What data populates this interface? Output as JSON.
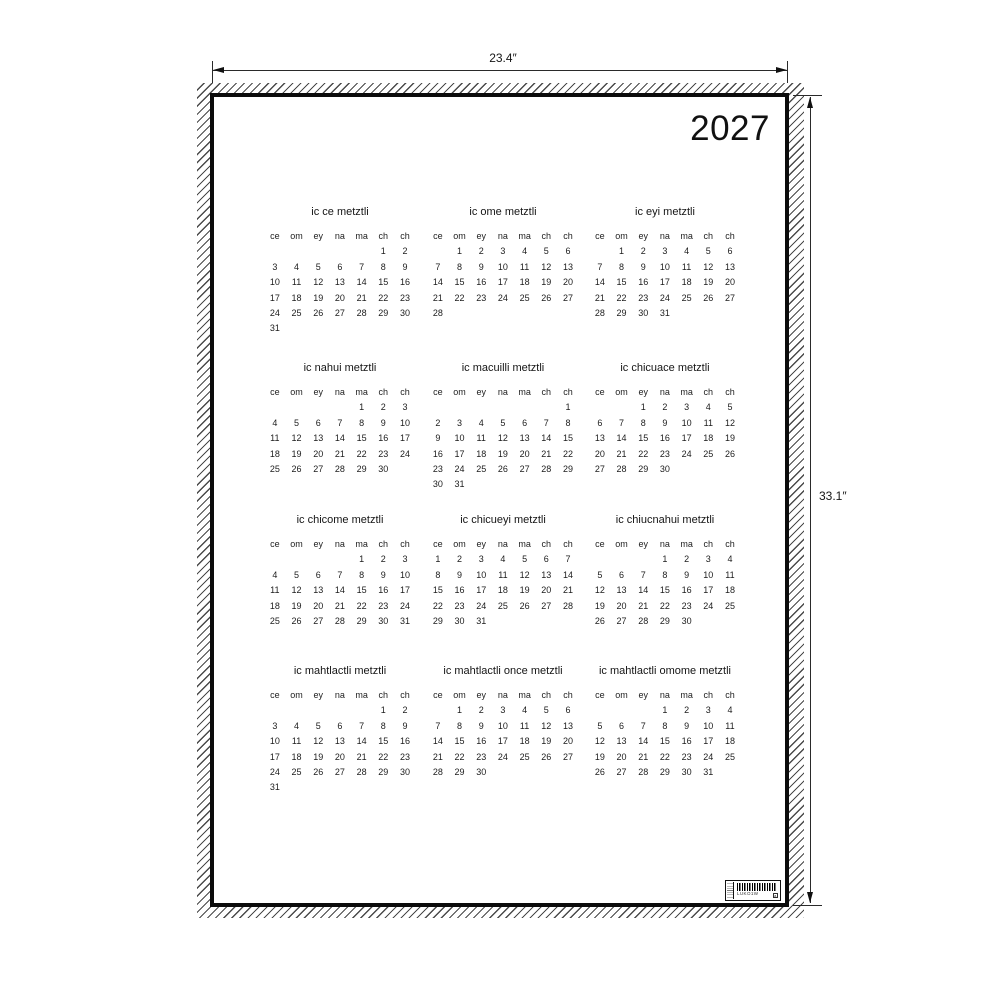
{
  "product": {
    "year": "2027",
    "width_label": "23.4″",
    "height_label": "33.1″"
  },
  "colors": {
    "paper": "#ffffff",
    "ink": "#1a1a1a",
    "border": "#0b0b0b",
    "hatch": "#4a4a4a"
  },
  "calendar": {
    "day_headers": [
      "ce",
      "om",
      "ey",
      "na",
      "ma",
      "ch",
      "ch"
    ],
    "months": [
      {
        "name": "ic ce metztli",
        "weeks": [
          [
            "",
            "",
            "",
            "",
            "",
            "1",
            "2"
          ],
          [
            "3",
            "4",
            "5",
            "6",
            "7",
            "8",
            "9"
          ],
          [
            "10",
            "11",
            "12",
            "13",
            "14",
            "15",
            "16"
          ],
          [
            "17",
            "18",
            "19",
            "20",
            "21",
            "22",
            "23"
          ],
          [
            "24",
            "25",
            "26",
            "27",
            "28",
            "29",
            "30"
          ],
          [
            "31",
            "",
            "",
            "",
            "",
            "",
            ""
          ]
        ]
      },
      {
        "name": "ic ome metztli",
        "weeks": [
          [
            "",
            "1",
            "2",
            "3",
            "4",
            "5",
            "6"
          ],
          [
            "7",
            "8",
            "9",
            "10",
            "11",
            "12",
            "13"
          ],
          [
            "14",
            "15",
            "16",
            "17",
            "18",
            "19",
            "20"
          ],
          [
            "21",
            "22",
            "23",
            "24",
            "25",
            "26",
            "27"
          ],
          [
            "28",
            "",
            "",
            "",
            "",
            "",
            ""
          ]
        ]
      },
      {
        "name": "ic eyi metztli",
        "weeks": [
          [
            "",
            "1",
            "2",
            "3",
            "4",
            "5",
            "6"
          ],
          [
            "7",
            "8",
            "9",
            "10",
            "11",
            "12",
            "13"
          ],
          [
            "14",
            "15",
            "16",
            "17",
            "18",
            "19",
            "20"
          ],
          [
            "21",
            "22",
            "23",
            "24",
            "25",
            "26",
            "27"
          ],
          [
            "28",
            "29",
            "30",
            "31",
            "",
            "",
            ""
          ]
        ]
      },
      {
        "name": "ic nahui metztli",
        "weeks": [
          [
            "",
            "",
            "",
            "",
            "1",
            "2",
            "3"
          ],
          [
            "4",
            "5",
            "6",
            "7",
            "8",
            "9",
            "10"
          ],
          [
            "11",
            "12",
            "13",
            "14",
            "15",
            "16",
            "17"
          ],
          [
            "18",
            "19",
            "20",
            "21",
            "22",
            "23",
            "24"
          ],
          [
            "25",
            "26",
            "27",
            "28",
            "29",
            "30",
            ""
          ]
        ]
      },
      {
        "name": "ic macuilli metztli",
        "weeks": [
          [
            "",
            "",
            "",
            "",
            "",
            "",
            "1"
          ],
          [
            "2",
            "3",
            "4",
            "5",
            "6",
            "7",
            "8"
          ],
          [
            "9",
            "10",
            "11",
            "12",
            "13",
            "14",
            "15"
          ],
          [
            "16",
            "17",
            "18",
            "19",
            "20",
            "21",
            "22"
          ],
          [
            "23",
            "24",
            "25",
            "26",
            "27",
            "28",
            "29"
          ],
          [
            "30",
            "31",
            "",
            "",
            "",
            "",
            ""
          ]
        ]
      },
      {
        "name": "ic chicuace metztli",
        "weeks": [
          [
            "",
            "",
            "1",
            "2",
            "3",
            "4",
            "5"
          ],
          [
            "6",
            "7",
            "8",
            "9",
            "10",
            "11",
            "12"
          ],
          [
            "13",
            "14",
            "15",
            "16",
            "17",
            "18",
            "19"
          ],
          [
            "20",
            "21",
            "22",
            "23",
            "24",
            "25",
            "26"
          ],
          [
            "27",
            "28",
            "29",
            "30",
            "",
            "",
            ""
          ]
        ]
      },
      {
        "name": "ic chicome metztli",
        "weeks": [
          [
            "",
            "",
            "",
            "",
            "1",
            "2",
            "3"
          ],
          [
            "4",
            "5",
            "6",
            "7",
            "8",
            "9",
            "10"
          ],
          [
            "11",
            "12",
            "13",
            "14",
            "15",
            "16",
            "17"
          ],
          [
            "18",
            "19",
            "20",
            "21",
            "22",
            "23",
            "24"
          ],
          [
            "25",
            "26",
            "27",
            "28",
            "29",
            "30",
            "31"
          ]
        ]
      },
      {
        "name": "ic chicueyi metztli",
        "weeks": [
          [
            "1",
            "2",
            "3",
            "4",
            "5",
            "6",
            "7"
          ],
          [
            "8",
            "9",
            "10",
            "11",
            "12",
            "13",
            "14"
          ],
          [
            "15",
            "16",
            "17",
            "18",
            "19",
            "20",
            "21"
          ],
          [
            "22",
            "23",
            "24",
            "25",
            "26",
            "27",
            "28"
          ],
          [
            "29",
            "30",
            "31",
            "",
            "",
            "",
            ""
          ]
        ]
      },
      {
        "name": "ic chiucnahui metztli",
        "weeks": [
          [
            "",
            "",
            "",
            "1",
            "2",
            "3",
            "4"
          ],
          [
            "5",
            "6",
            "7",
            "8",
            "9",
            "10",
            "11"
          ],
          [
            "12",
            "13",
            "14",
            "15",
            "16",
            "17",
            "18"
          ],
          [
            "19",
            "20",
            "21",
            "22",
            "23",
            "24",
            "25"
          ],
          [
            "26",
            "27",
            "28",
            "29",
            "30",
            "",
            ""
          ]
        ]
      },
      {
        "name": "ic mahtlactli metztli",
        "weeks": [
          [
            "",
            "",
            "",
            "",
            "",
            "1",
            "2"
          ],
          [
            "3",
            "4",
            "5",
            "6",
            "7",
            "8",
            "9"
          ],
          [
            "10",
            "11",
            "12",
            "13",
            "14",
            "15",
            "16"
          ],
          [
            "17",
            "18",
            "19",
            "20",
            "21",
            "22",
            "23"
          ],
          [
            "24",
            "25",
            "26",
            "27",
            "28",
            "29",
            "30"
          ],
          [
            "31",
            "",
            "",
            "",
            "",
            "",
            ""
          ]
        ]
      },
      {
        "name": "ic mahtlactli once metztli",
        "weeks": [
          [
            "",
            "1",
            "2",
            "3",
            "4",
            "5",
            "6"
          ],
          [
            "7",
            "8",
            "9",
            "10",
            "11",
            "12",
            "13"
          ],
          [
            "14",
            "15",
            "16",
            "17",
            "18",
            "19",
            "20"
          ],
          [
            "21",
            "22",
            "23",
            "24",
            "25",
            "26",
            "27"
          ],
          [
            "28",
            "29",
            "30",
            "",
            "",
            "",
            ""
          ]
        ]
      },
      {
        "name": "ic mahtlactli omome metztli",
        "weeks": [
          [
            "",
            "",
            "",
            "1",
            "2",
            "3",
            "4"
          ],
          [
            "5",
            "6",
            "7",
            "8",
            "9",
            "10",
            "11"
          ],
          [
            "12",
            "13",
            "14",
            "15",
            "16",
            "17",
            "18"
          ],
          [
            "19",
            "20",
            "21",
            "22",
            "23",
            "24",
            "25"
          ],
          [
            "26",
            "27",
            "28",
            "29",
            "30",
            "31",
            ""
          ]
        ]
      }
    ]
  },
  "barcode": {
    "code": "LUKO1W",
    "box_glyph": "a"
  }
}
